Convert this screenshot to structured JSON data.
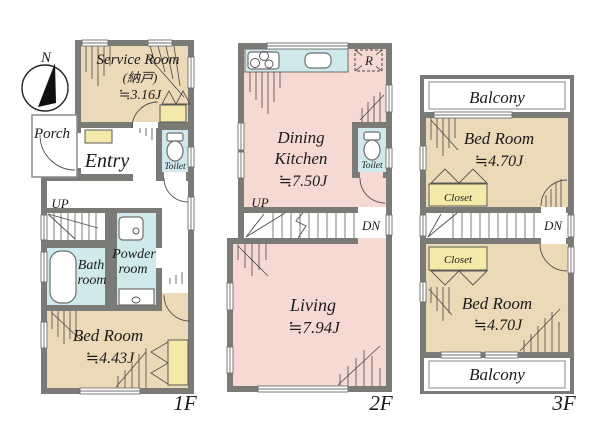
{
  "compass": {
    "north_label": "N"
  },
  "palette": {
    "wall": "#7a7a77",
    "room_tan": "#ecd9b8",
    "room_pink": "#f7d9d4",
    "wet_area_cyan": "#cfe9ec",
    "closet_yellow": "#f3eaa9",
    "background": "#ffffff",
    "text": "#1b1b1b"
  },
  "floor1": {
    "floor_label": "1F",
    "service_room": {
      "line1": "Service Room",
      "line2": "(納戸)",
      "size": "≒3.16J"
    },
    "porch": "Porch",
    "entry": "Entry",
    "toilet": "Toilet",
    "stairs_up": "UP",
    "bath_room": {
      "line1": "Bath",
      "line2": "room"
    },
    "powder_room": {
      "line1": "Powder",
      "line2": "room"
    },
    "bed_room": {
      "line1": "Bed Room",
      "size": "≒4.43J"
    }
  },
  "floor2": {
    "floor_label": "2F",
    "dining_kitchen": {
      "line1": "Dining",
      "line2": "Kitchen",
      "size": "≒7.50J"
    },
    "refrigerator": "R",
    "toilet": "Toilet",
    "stairs_up": "UP",
    "stairs_down": "DN",
    "living": {
      "line1": "Living",
      "size": "≒7.94J"
    }
  },
  "floor3": {
    "floor_label": "3F",
    "balcony_top": "Balcony",
    "bed_room_top": {
      "line1": "Bed Room",
      "size": "≒4.70J"
    },
    "closet_top": "Closet",
    "stairs_down": "DN",
    "closet_bottom": "Closet",
    "bed_room_bottom": {
      "line1": "Bed Room",
      "size": "≒4.70J"
    },
    "balcony_bottom": "Balcony"
  }
}
